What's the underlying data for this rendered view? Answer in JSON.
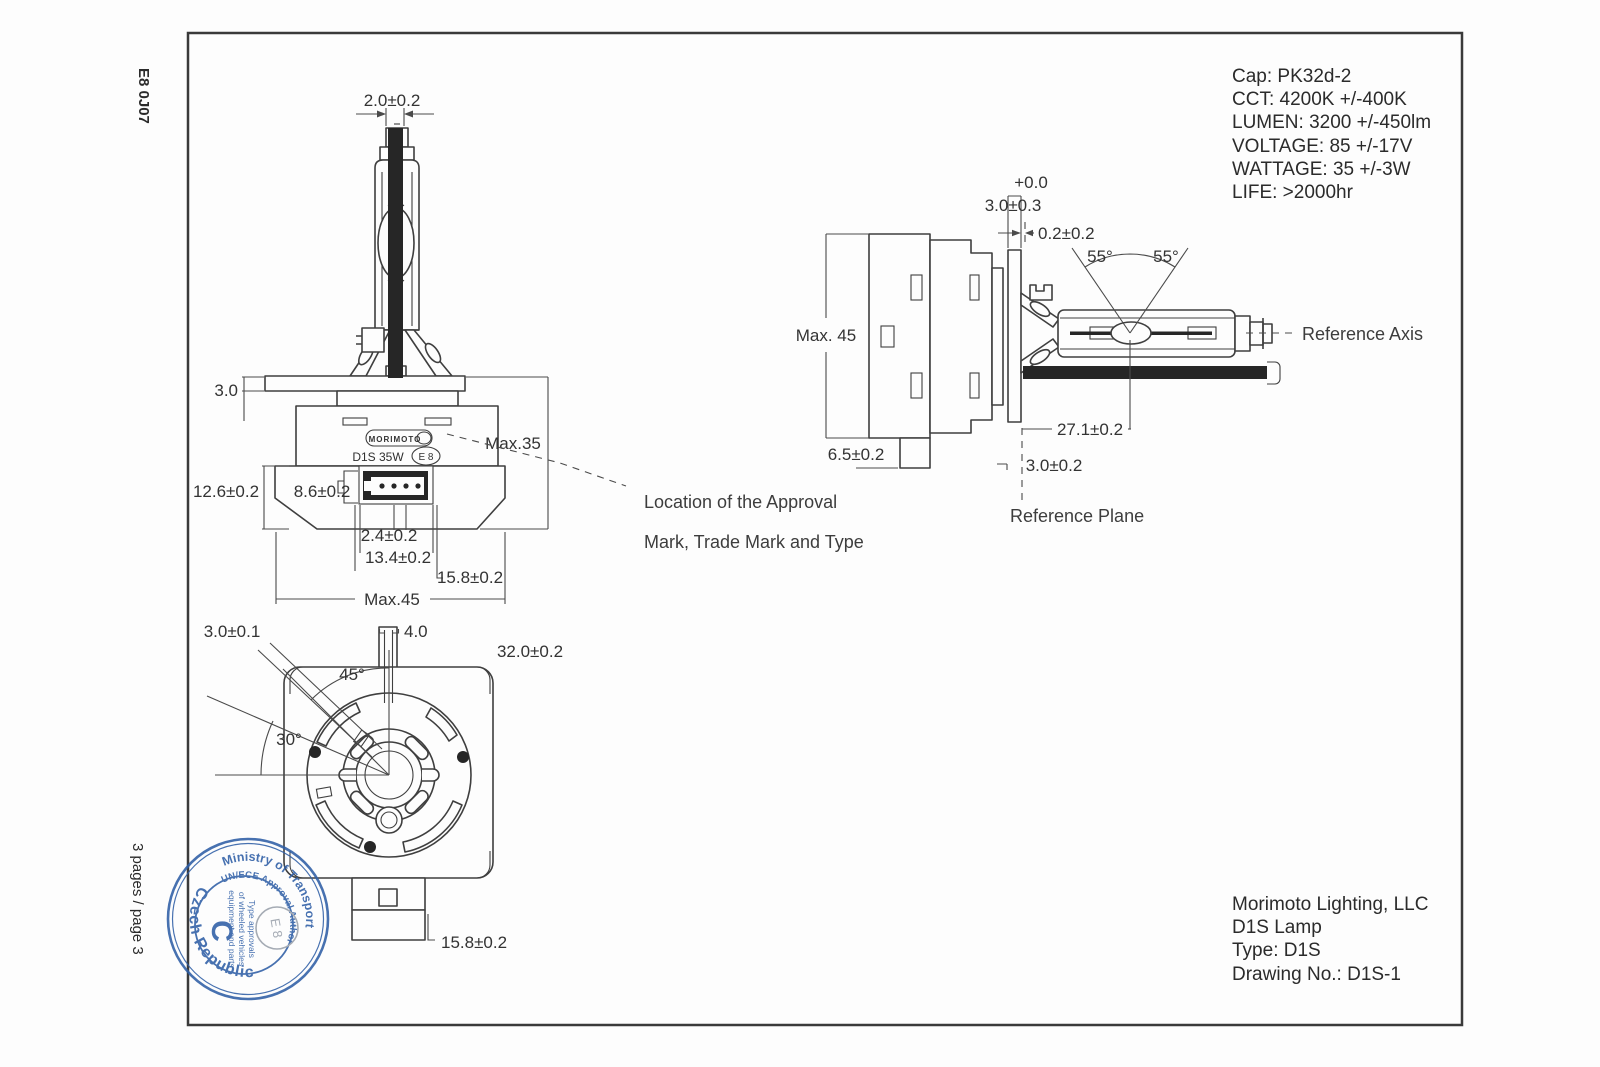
{
  "frame": {
    "code": "E8 0J07",
    "pages": "3 pages / page 3"
  },
  "specs": {
    "lines": [
      "Cap: PK32d-2",
      "CCT: 4200K +/-400K",
      "LUMEN: 3200 +/-450lm",
      "VOLTAGE: 85 +/-17V",
      "WATTAGE: 35 +/-3W",
      "LIFE: >2000hr"
    ]
  },
  "title_block": {
    "company": "Morimoto Lighting, LLC",
    "product": "D1S Lamp",
    "type": "Type: D1S",
    "drawing_no": "Drawing No.: D1S-1"
  },
  "callout": {
    "line1": "Location of the Approval",
    "line2": "Mark, Trade Mark and Type"
  },
  "front_view": {
    "tip_width": "2.0±0.2",
    "flange_thickness": "3.0",
    "height_max": "Max.35",
    "body_height": "12.6±0.2",
    "step_height": "8.6±0.2",
    "pin_pitch": "2.4±0.2",
    "connector_width": "13.4±0.2",
    "connector_outer_width": "15.8±0.2",
    "width_max": "Max.45",
    "logo": "MORIMOTO",
    "type_marking": "D1S 35W",
    "e_mark": "E 8"
  },
  "side_view": {
    "upper_tol": "+0.0",
    "flange_width": "3.0±0.3",
    "gap": "0.2±0.2",
    "height_max": "Max. 45",
    "tab_height": "6.5±0.2",
    "arc_to_plane": "27.1±0.2",
    "plane_offset": "3.0±0.2",
    "angle_left": "55°",
    "angle_right": "55°",
    "reference_axis": "Reference Axis",
    "reference_plane": "Reference Plane"
  },
  "bottom_view": {
    "key_width": "3.0±0.1",
    "slot_width": "4.0",
    "body_width": "32.0±0.2",
    "angle_top": "45°",
    "angle_side": "30°",
    "tab_width": "15.8±0.2"
  },
  "stamp": {
    "country": "Czech Republic",
    "ministry": "Ministry of Transport",
    "authority": "UN/ECE Approval Authority",
    "category": "C",
    "scope_lines": [
      "Type approvals",
      "of wheeled vehicles",
      "equipment and parts"
    ],
    "e_mark": "E 8"
  },
  "colors": {
    "line": "#3f3f3f",
    "stamp_blue": "#2e5ea6",
    "e_badge_gray": "#99a0aa"
  }
}
